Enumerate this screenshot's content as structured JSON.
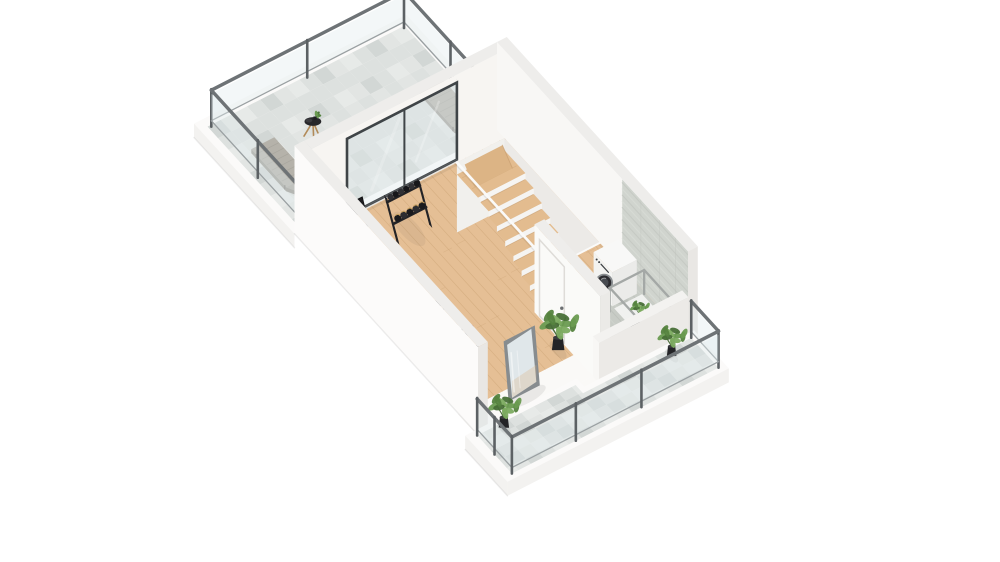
{
  "meta": {
    "description": "3D isometric floor-plan render of a home gym level with roof terrace, staircase opening, laundry nook and wrap-around balcony",
    "background": "#ffffff"
  },
  "palette": {
    "bg": "#ffffff",
    "wall_inner": "#f7f5f2",
    "wall_bright": "#fcfbfa",
    "wall_top": "#eeedeb",
    "wall_shade": "#e9e7e4",
    "slab_side": "#f3f2f0",
    "wood_floor": "#e5bf95",
    "wood_line": "#c79e6f",
    "stair_wood": "#e3bc8f",
    "tile_a": "#e7eae8",
    "tile_b": "#dde1df",
    "tile_c": "#d2d7d5",
    "tile_d": "#e2e5e3",
    "plank_tile": "#c8ccc6",
    "plank_line_dark": "#b9bdb7",
    "plank_line_light": "#d3d7d1",
    "tile_wall": "#d0d4ce",
    "rail_metal": "#6e7376",
    "rail_post": "#5c6164",
    "glass": "#dfe9ed",
    "window_frame": "#3f4447",
    "equipment_black": "#232326",
    "equipment_dark": "#18181b",
    "accent_red": "#b23a32",
    "handle_tan": "#c59e5e",
    "lounger_gray": "#b5b2aa",
    "lounger_shade": "#a19e96",
    "metal_frame": "#a4a8a6",
    "mirror_frame": "#878c8f",
    "mirror_glass": "#e0e7ea",
    "pot_black": "#232326",
    "leaf_1": "#6a9b51",
    "leaf_2": "#55833f",
    "leaf_3": "#7cab60",
    "leaf_4": "#486f37",
    "washer_white": "#f8f8f7",
    "washer_door": "#2b2b2f"
  },
  "rooms": [
    {
      "name": "terrace",
      "floor": "stone-tiles",
      "features": [
        "glass-railing",
        "sun-lounger-left",
        "sun-lounger-right",
        "side-table-with-plant"
      ]
    },
    {
      "name": "gym",
      "floor": "oak-wood",
      "features": [
        "sliding-glass-window",
        "dumbbell-rack",
        "treadmill",
        "workout-bench",
        "floor-dumbbells",
        "exercise-bike",
        "leaning-mirror",
        "staircase-opening",
        "potted-plant"
      ]
    },
    {
      "name": "laundry",
      "floor": "gray-plank-tiles",
      "features": [
        "washing-machine",
        "metal-frame-table",
        "small-plant",
        "tiled-wall",
        "door-to-gym"
      ]
    },
    {
      "name": "balcony",
      "floor": "stone-tiles",
      "features": [
        "glass-railing",
        "potted-plant-near-laundry",
        "potted-plant-corner"
      ]
    }
  ],
  "items": [
    {
      "type": "lounger",
      "name": "sun-lounger-right",
      "room": "terrace",
      "l": 78,
      "w": 12
    },
    {
      "type": "lounger",
      "name": "sun-lounger-left",
      "room": "terrace",
      "l": 50,
      "w": 196
    },
    {
      "type": "side-table",
      "name": "terrace-side-table",
      "room": "terrace",
      "l": 62,
      "w": 158
    },
    {
      "type": "rack",
      "name": "dumbbell-rack",
      "room": "gym",
      "l": 190,
      "w": 128
    },
    {
      "type": "treadmill",
      "name": "treadmill",
      "room": "gym",
      "l": 186,
      "w": 186
    },
    {
      "type": "bench",
      "name": "workout-bench",
      "room": "gym",
      "l": 288,
      "w": 196
    },
    {
      "type": "minirack",
      "name": "floor-dumbbells",
      "room": "gym",
      "l": 306,
      "w": 212
    },
    {
      "type": "bike",
      "name": "exercise-bike",
      "room": "gym",
      "l": 336,
      "w": 186
    },
    {
      "type": "mirror",
      "name": "leaning-mirror",
      "room": "gym",
      "l": 428,
      "w": 196
    },
    {
      "type": "plant",
      "name": "gym-plant",
      "room": "gym",
      "l": 402,
      "w": 116,
      "s": 1.25
    },
    {
      "type": "washer",
      "name": "washing-machine",
      "room": "laundry",
      "l": 356,
      "w": 8
    },
    {
      "type": "frame-table",
      "name": "laundry-table",
      "room": "laundry",
      "l": 390,
      "w": 2
    },
    {
      "type": "plant",
      "name": "balcony-plant-near-laundry",
      "room": "balcony",
      "l": 466,
      "w": 26,
      "s": 0.95
    },
    {
      "type": "plant",
      "name": "balcony-plant-corner",
      "room": "balcony",
      "l": 452,
      "w": 220,
      "s": 1.05
    }
  ]
}
